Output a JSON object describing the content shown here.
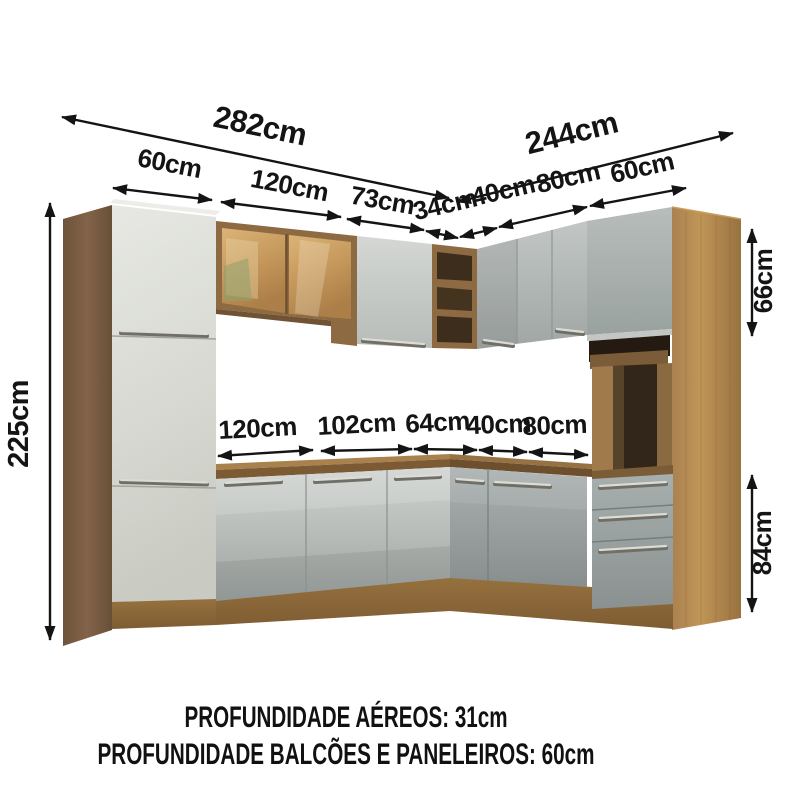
{
  "dimensions": {
    "total_left_width": "282cm",
    "total_right_width": "244cm",
    "top_row": [
      "60cm",
      "120cm",
      "73cm",
      "34cm",
      "40cm",
      "80cm",
      "60cm"
    ],
    "counter_row": [
      "120cm",
      "102cm",
      "64cm",
      "40cm",
      "80cm"
    ],
    "height_total": "225cm",
    "upper_right_height": "66cm",
    "base_right_height": "84cm"
  },
  "footer": {
    "line1": "PROFUNDIDADE AÉREOS: 31cm",
    "line2": "PROFUNDIDADE BALCÕES E PANELEIROS: 60cm"
  },
  "colors": {
    "annotation": "#141414",
    "background": "#ffffff",
    "wood": "#9a7548",
    "wood_dark": "#6e5338",
    "cabinet_gray": "#b6bcba",
    "door_white": "#dcded8",
    "glass_amber": "#c89a5e",
    "handle_silver": "#d6d6cf"
  }
}
